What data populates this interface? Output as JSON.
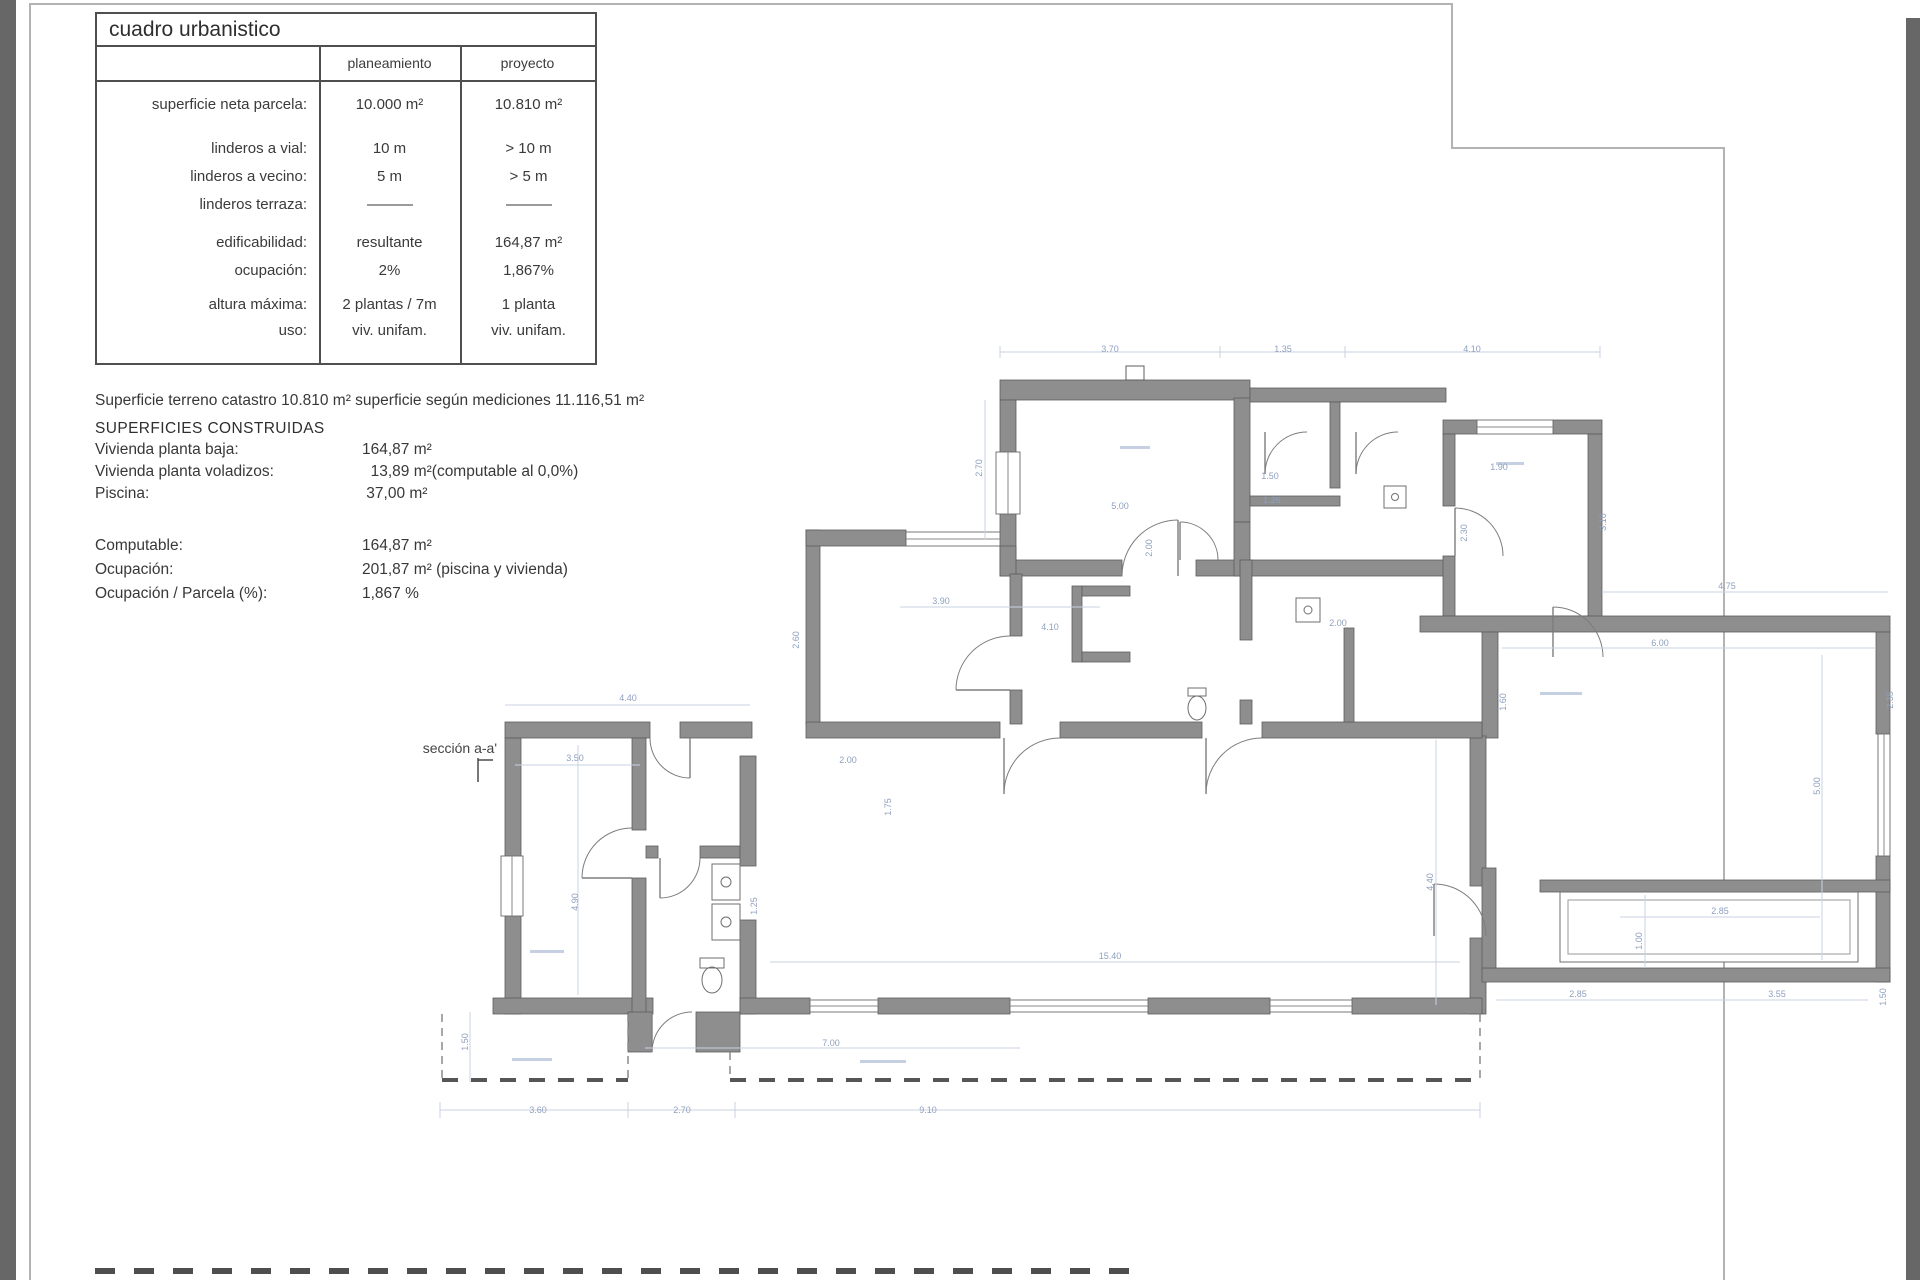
{
  "colors": {
    "wall_gray": "#8e8e8e",
    "wall_edge": "#5d5d5d",
    "dimension_blue": "#8fa0bf",
    "sheet_border": "#b3b3b3",
    "scan_edge": "#676767"
  },
  "table": {
    "title": "cuadro urbanistico",
    "columns": [
      "planeamiento",
      "proyecto"
    ],
    "rows": [
      {
        "label": "superficie neta parcela:",
        "planeamiento": "10.000 m²",
        "proyecto": "10.810 m²"
      },
      {
        "label": "linderos a vial:",
        "planeamiento": "10 m",
        "proyecto": "> 10 m"
      },
      {
        "label": "linderos a vecino:",
        "planeamiento": "5 m",
        "proyecto": "> 5 m"
      },
      {
        "label": "linderos terraza:",
        "planeamiento": "——",
        "proyecto": "——"
      },
      {
        "label": "edificabilidad:",
        "planeamiento": "resultante",
        "proyecto": "164,87 m²"
      },
      {
        "label": "ocupación:",
        "planeamiento": "2%",
        "proyecto": "1,867%"
      },
      {
        "label": "altura máxima:",
        "planeamiento": "2 plantas / 7m",
        "proyecto": "1 planta"
      },
      {
        "label": "uso:",
        "planeamiento": "viv. unifam.",
        "proyecto": "viv. unifam."
      }
    ]
  },
  "notes": {
    "catastro": "Superficie terreno catastro 10.810 m² superficie según mediciones 11.116,51 m²"
  },
  "superficies": {
    "heading": "SUPERFICIES CONSTRUIDAS",
    "rows": [
      {
        "label": "Vivienda planta baja:",
        "value": "164,87 m²"
      },
      {
        "label": "Vivienda planta voladizos:",
        "value": "  13,89 m²(computable al 0,0%)"
      },
      {
        "label": "Piscina:",
        "value": " 37,00 m²"
      }
    ]
  },
  "totales": {
    "rows": [
      {
        "label": "Computable:",
        "value": "164,87 m²"
      },
      {
        "label": "Ocupación:",
        "value": "201,87 m² (piscina y vivienda)"
      },
      {
        "label": "Ocupación / Parcela (%):",
        "value": "1,867 %"
      }
    ]
  },
  "plan": {
    "section_label": "sección a-a'",
    "dims": [
      {
        "t": "3.70",
        "x": 1110,
        "y": 352
      },
      {
        "t": "1.35",
        "x": 1283,
        "y": 352
      },
      {
        "t": "4.10",
        "x": 1472,
        "y": 352
      },
      {
        "t": "2.70",
        "x": 982,
        "y": 468,
        "rot": true
      },
      {
        "t": "5.00",
        "x": 1120,
        "y": 509
      },
      {
        "t": "2.00",
        "x": 1152,
        "y": 548,
        "rot": true
      },
      {
        "t": "3.90",
        "x": 941,
        "y": 604
      },
      {
        "t": "4.10",
        "x": 1050,
        "y": 630
      },
      {
        "t": "2.60",
        "x": 799,
        "y": 640,
        "rot": true
      },
      {
        "t": "1.50",
        "x": 1270,
        "y": 479
      },
      {
        "t": "1.26",
        "x": 1272,
        "y": 503
      },
      {
        "t": "1.90",
        "x": 1499,
        "y": 470
      },
      {
        "t": "2.30",
        "x": 1467,
        "y": 533,
        "rot": true
      },
      {
        "t": "3.10",
        "x": 1606,
        "y": 522,
        "rot": true
      },
      {
        "t": "4.75",
        "x": 1727,
        "y": 589
      },
      {
        "t": "6.00",
        "x": 1660,
        "y": 646
      },
      {
        "t": "2.00",
        "x": 1338,
        "y": 626
      },
      {
        "t": "1.60",
        "x": 1506,
        "y": 702,
        "rot": true
      },
      {
        "t": "4.40",
        "x": 628,
        "y": 701
      },
      {
        "t": "3.50",
        "x": 575,
        "y": 761
      },
      {
        "t": "2.00",
        "x": 848,
        "y": 763
      },
      {
        "t": "1.75",
        "x": 891,
        "y": 807,
        "rot": true
      },
      {
        "t": "4.90",
        "x": 578,
        "y": 902,
        "rot": true
      },
      {
        "t": "1.25",
        "x": 757,
        "y": 906,
        "rot": true
      },
      {
        "t": "15.40",
        "x": 1110,
        "y": 959
      },
      {
        "t": "4.40",
        "x": 1433,
        "y": 882,
        "rot": true
      },
      {
        "t": "7.00",
        "x": 831,
        "y": 1046
      },
      {
        "t": "3.60",
        "x": 538,
        "y": 1113
      },
      {
        "t": "2.70",
        "x": 682,
        "y": 1113
      },
      {
        "t": "9.10",
        "x": 928,
        "y": 1113
      },
      {
        "t": "1.50",
        "x": 468,
        "y": 1042,
        "rot": true
      },
      {
        "t": "5.00",
        "x": 1820,
        "y": 786,
        "rot": true
      },
      {
        "t": "2.85",
        "x": 1578,
        "y": 997
      },
      {
        "t": "3.55",
        "x": 1777,
        "y": 997
      },
      {
        "t": "1.00",
        "x": 1642,
        "y": 941,
        "rot": true
      },
      {
        "t": "2.85",
        "x": 1720,
        "y": 914
      },
      {
        "t": "1.50",
        "x": 1886,
        "y": 997,
        "rot": true
      },
      {
        "t": "2.35",
        "x": 1893,
        "y": 700,
        "rot": true
      }
    ]
  }
}
